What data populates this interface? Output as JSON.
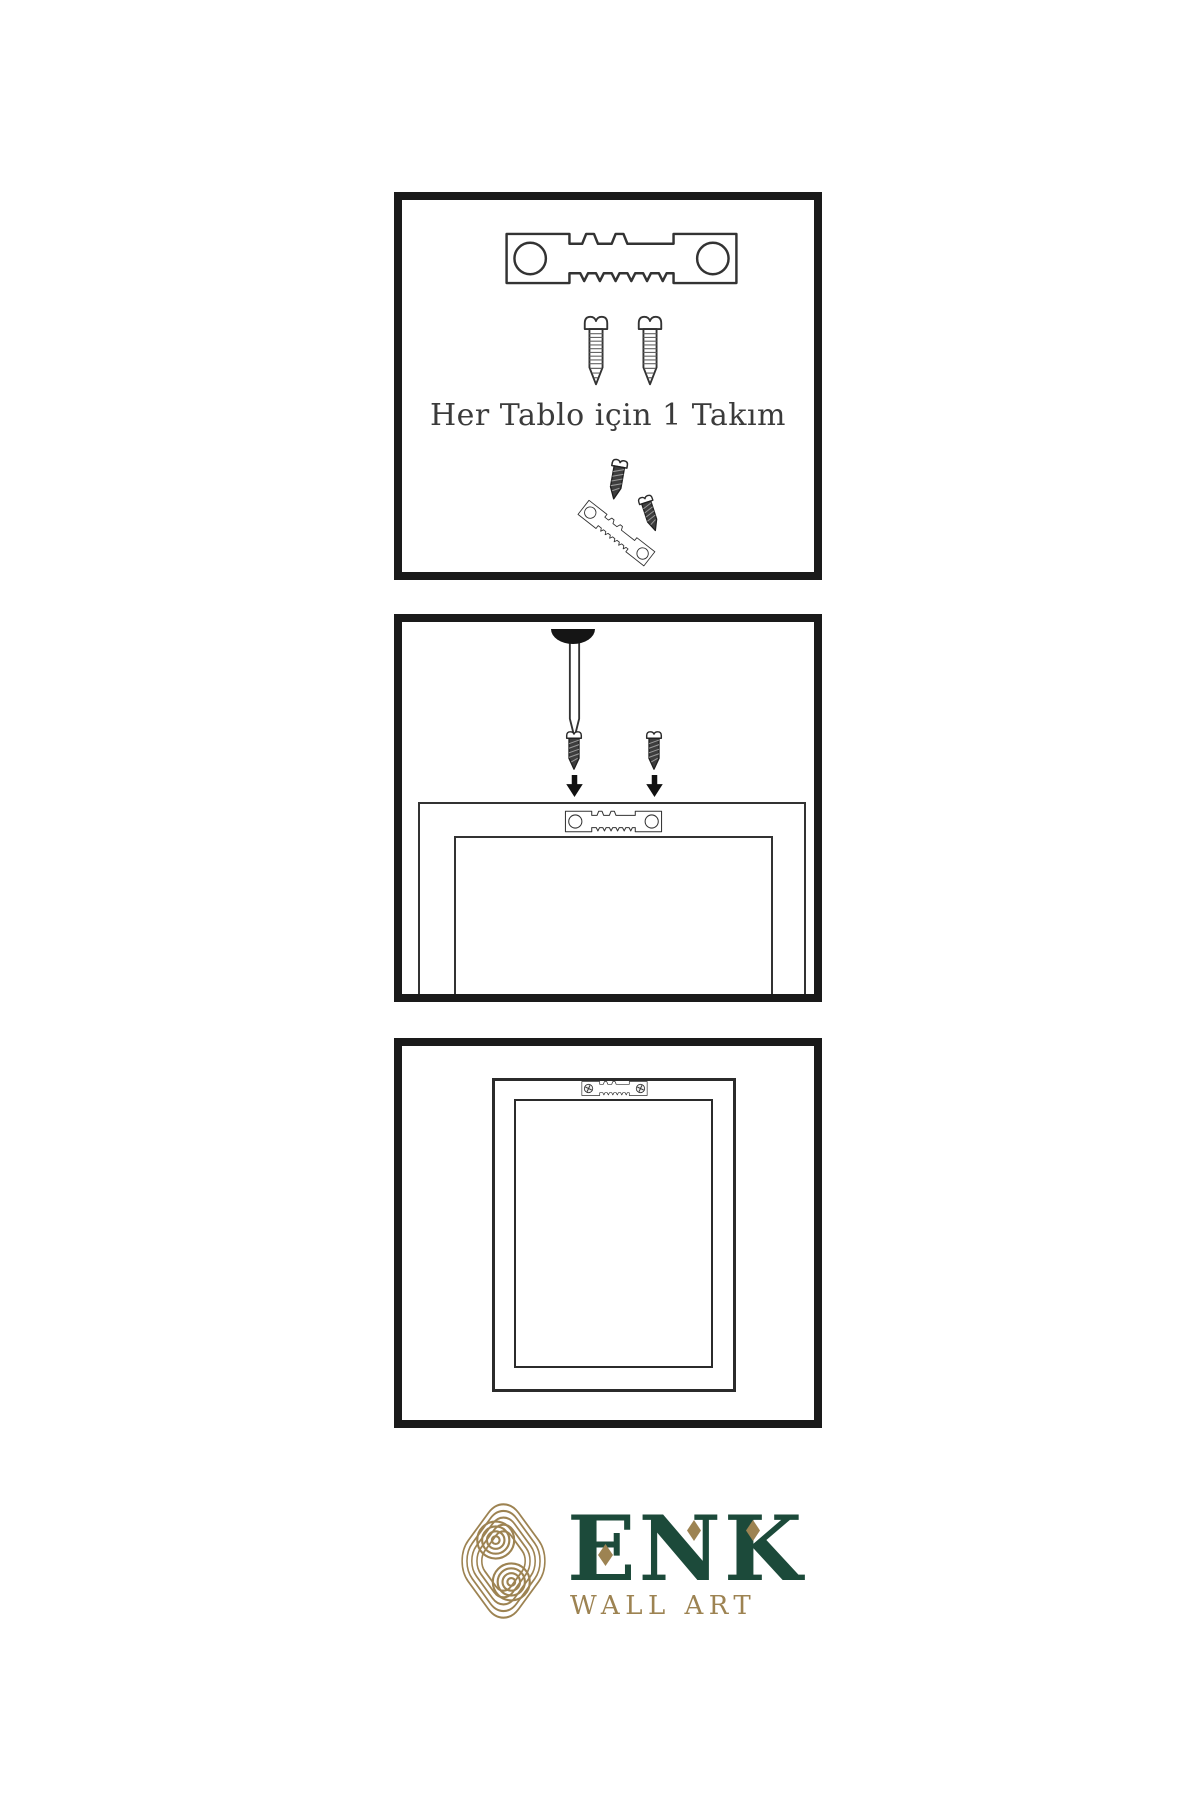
{
  "colors": {
    "background": "#ffffff",
    "panel_border": "#1a1a1a",
    "line_art": "#333333",
    "screw_dark": "#3d3d3d",
    "caption_text": "#3b3b3b",
    "brand_green": "#1c4a3a",
    "brand_gold": "#9d8352"
  },
  "panels": [
    {
      "id": "hardware-kit",
      "caption": "Her Tablo için 1 Takım",
      "icons": [
        "sawtooth-hanger-icon",
        "screw-icon",
        "screw-icon",
        "small-screw-icon",
        "angled-sawtooth-hanger-icon",
        "small-screw-icon"
      ]
    },
    {
      "id": "mounting-step",
      "icons": [
        "nail-icon",
        "nail-head-bump",
        "small-screw-icon",
        "small-screw-icon",
        "arrow-down-icon",
        "arrow-down-icon",
        "sawtooth-hanger-icon",
        "frame-back-outline"
      ]
    },
    {
      "id": "hung-frame",
      "icons": [
        "sawtooth-hanger-installed-icon",
        "frame-front-outline"
      ]
    }
  ],
  "logo": {
    "brand": "ENK",
    "subtitle": "WALL ART",
    "mark": "interlocking-knot-icon"
  }
}
